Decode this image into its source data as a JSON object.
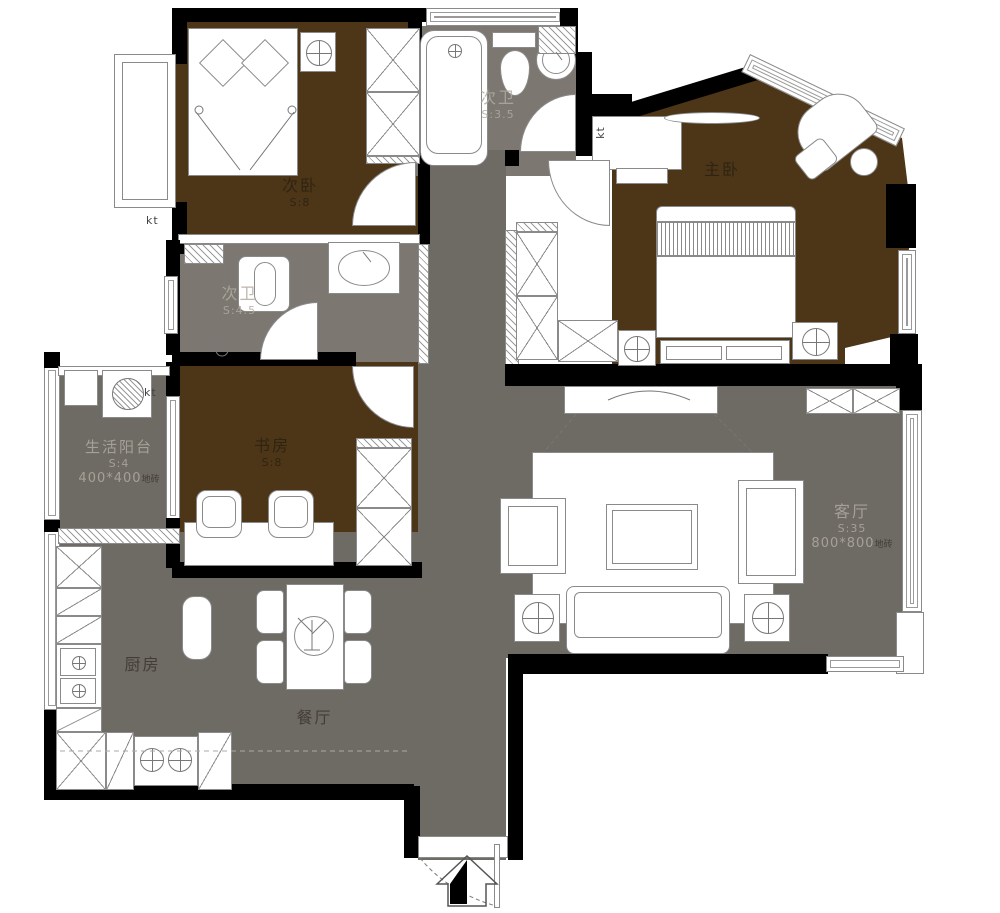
{
  "rooms": {
    "ci_bedroom": {
      "name": "次卧",
      "area": "S:8"
    },
    "bath_top": {
      "name": "次卫",
      "area": "S:3.5"
    },
    "master_bedroom": {
      "name": "主卧"
    },
    "bath_mid": {
      "name": "次卫",
      "area": "S:4.5"
    },
    "balcony": {
      "name": "生活阳台",
      "area": "S:4",
      "tile": "400*400",
      "tile_unit": "地砖"
    },
    "study": {
      "name": "书房",
      "area": "S:8"
    },
    "living": {
      "name": "客厅",
      "area": "S:35",
      "tile": "800*800",
      "tile_unit": "地砖"
    },
    "kitchen": {
      "name": "厨房"
    },
    "dining": {
      "name": "餐厅"
    }
  },
  "annotations": {
    "kt_left_top": "kt",
    "kt_left_mid": "kt",
    "kt_top_right": "kt"
  },
  "colors": {
    "bedroom_floor": "#4d3517",
    "public_floor": "#6e6a64",
    "bath_floor": "#7c7871",
    "wall": "#000000"
  }
}
